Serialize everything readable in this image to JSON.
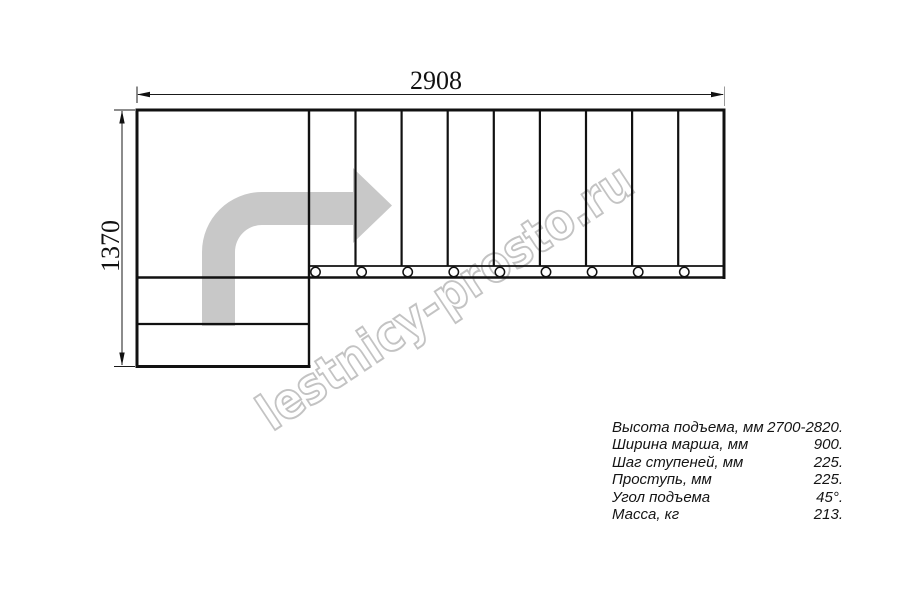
{
  "drawing": {
    "width_label": "2908",
    "height_label": "1370"
  },
  "watermark": {
    "text": "lestnicy-prosto.ru",
    "color": "#c3c3c3"
  },
  "arrow": {
    "color": "#c8c8c8"
  },
  "specs": {
    "rows": [
      {
        "label": "Высота подъема, мм",
        "value": "2700-2820."
      },
      {
        "label": "Ширина марша, мм",
        "value": "900."
      },
      {
        "label": "Шаг ступеней, мм",
        "value": "225."
      },
      {
        "label": "Проступь, мм",
        "value": "225."
      },
      {
        "label": "Угол подъема",
        "value": "45°."
      },
      {
        "label": "Масса, кг",
        "value": "213."
      }
    ]
  }
}
